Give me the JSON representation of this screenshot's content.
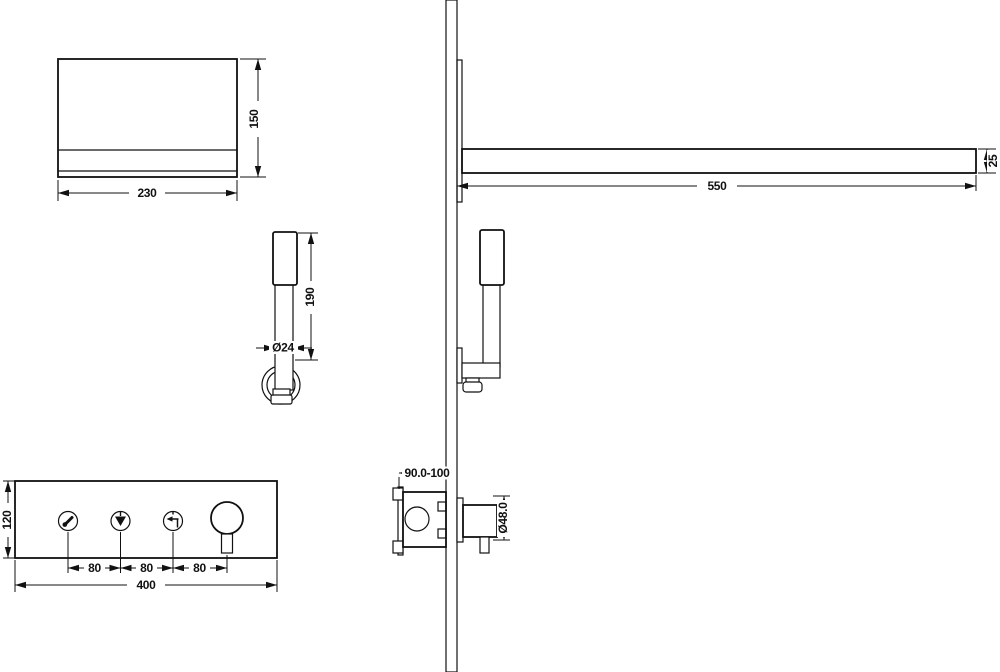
{
  "drawing": {
    "type": "shower-system-installation-technical-drawing",
    "colors": {
      "line": "#111111",
      "background": "#ffffff"
    },
    "dimensions": {
      "head_width": "230",
      "head_height": "150",
      "arm_length": "550",
      "arm_thickness": "25",
      "wand_length": "190",
      "wand_diameter": "Ø24",
      "panel_height": "120",
      "panel_spacing": [
        "80",
        "80",
        "80"
      ],
      "panel_width": "400",
      "valve_depth_range": "90.0-100",
      "valve_knob_diameter": "Ø48.0"
    }
  }
}
